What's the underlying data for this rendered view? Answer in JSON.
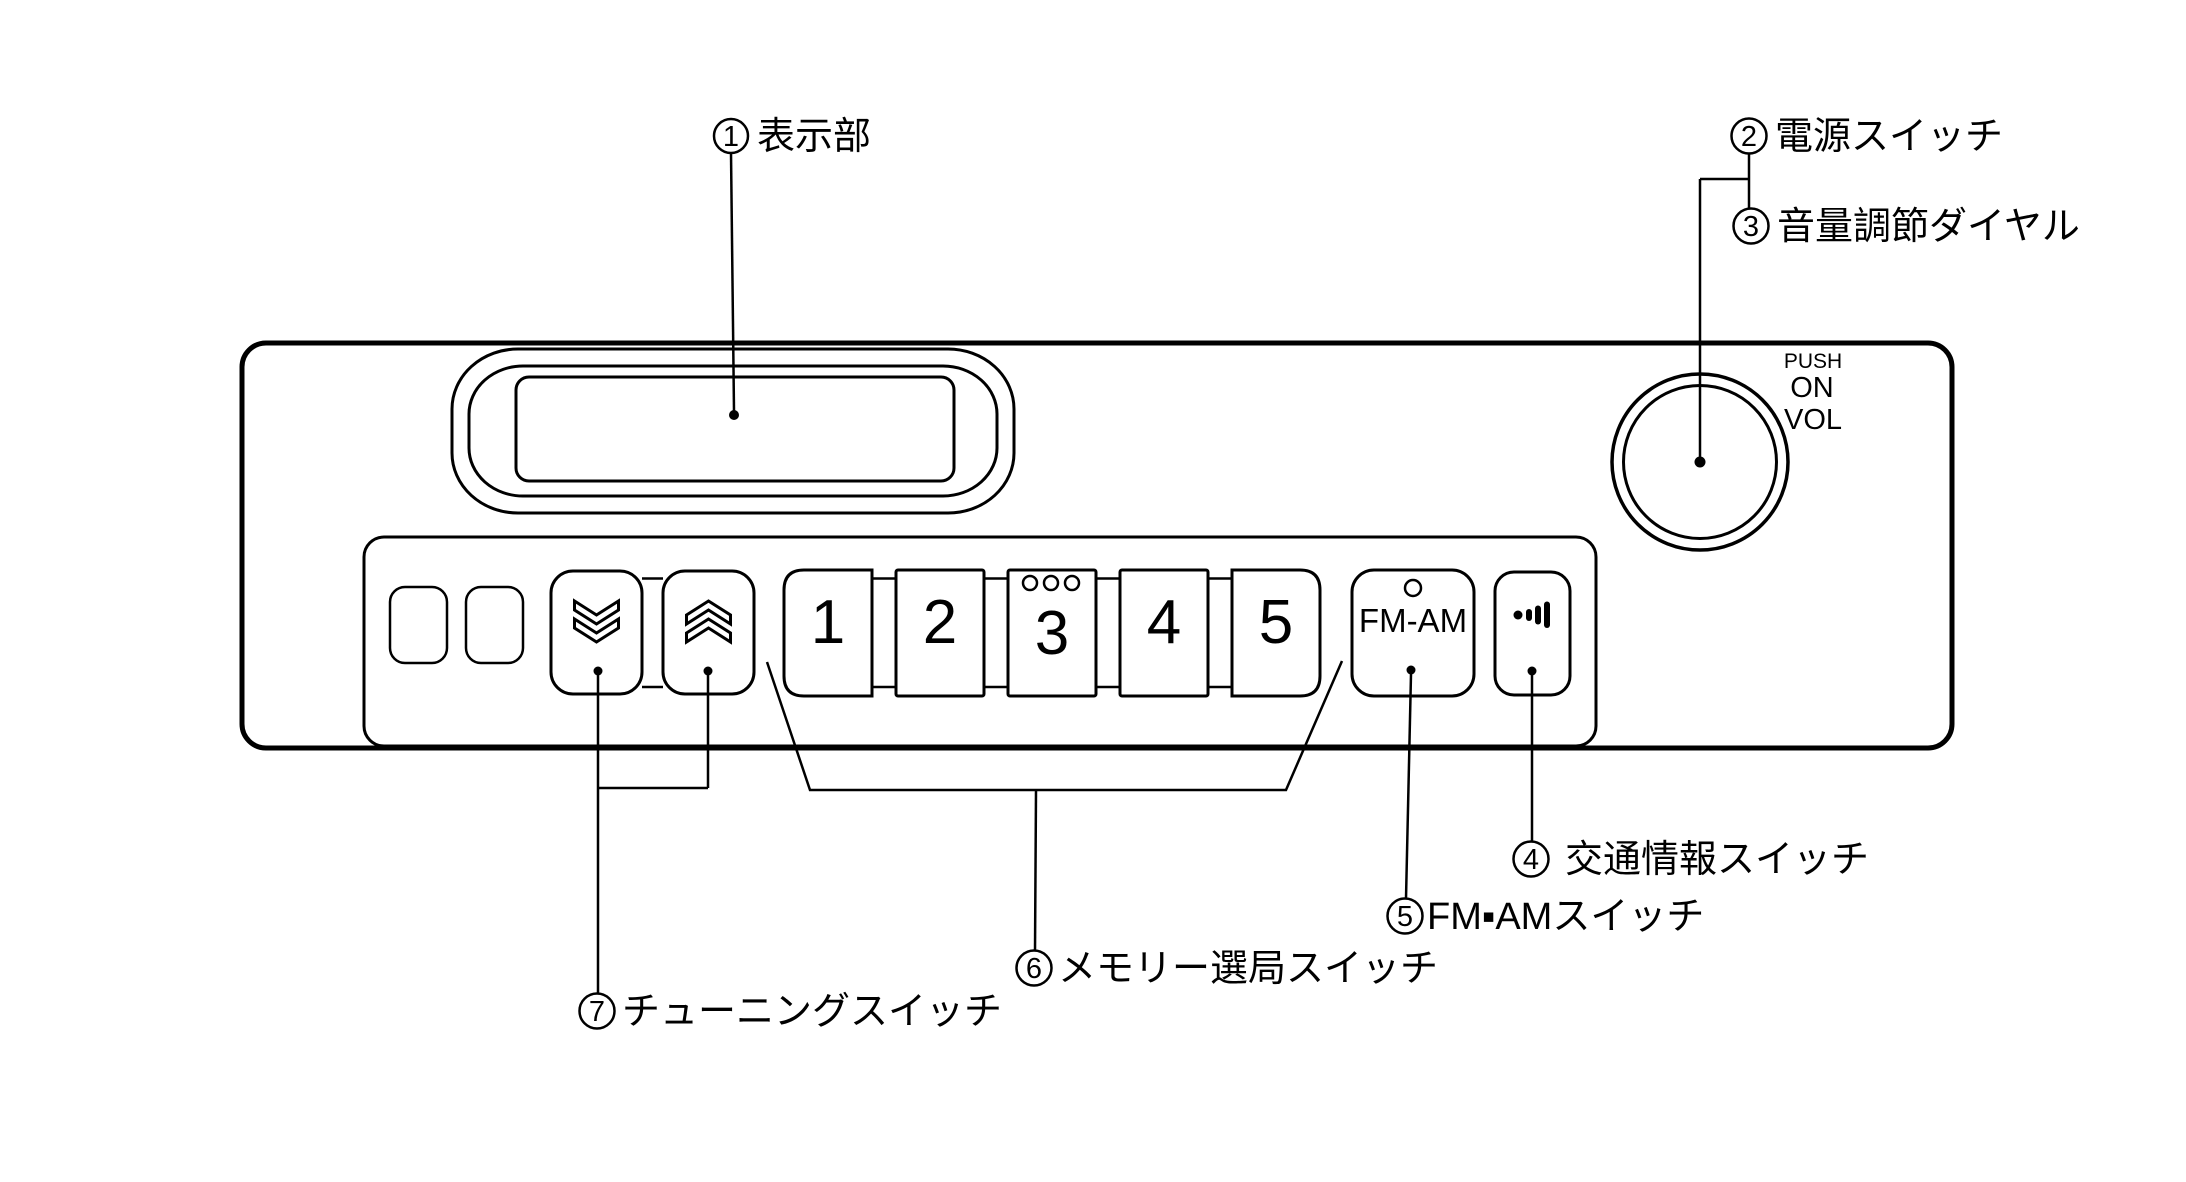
{
  "diagram_title": "radio-front-panel-callout-diagram",
  "callouts": {
    "display": {
      "num": "1",
      "label": "表示部"
    },
    "power": {
      "num": "2",
      "label": "電源スイッチ"
    },
    "volume_dial": {
      "num": "3",
      "label": "音量調節ダイヤル"
    },
    "traffic_info": {
      "num": "4",
      "label": "交通情報スイッチ"
    },
    "fm_am": {
      "num": "5",
      "label": "FM▪AMスイッチ"
    },
    "memory_preset": {
      "num": "6",
      "label": "メモリー選局スイッチ"
    },
    "tuning": {
      "num": "7",
      "label": "チューニングスイッチ"
    }
  },
  "knob_markings": {
    "push": "PUSH",
    "on": "ON",
    "vol": "VOL"
  },
  "preset_buttons": [
    "1",
    "2",
    "3",
    "4",
    "5"
  ],
  "fm_am_button_label": "FM-AM",
  "colors": {
    "line": "#000000",
    "background": "#ffffff"
  }
}
